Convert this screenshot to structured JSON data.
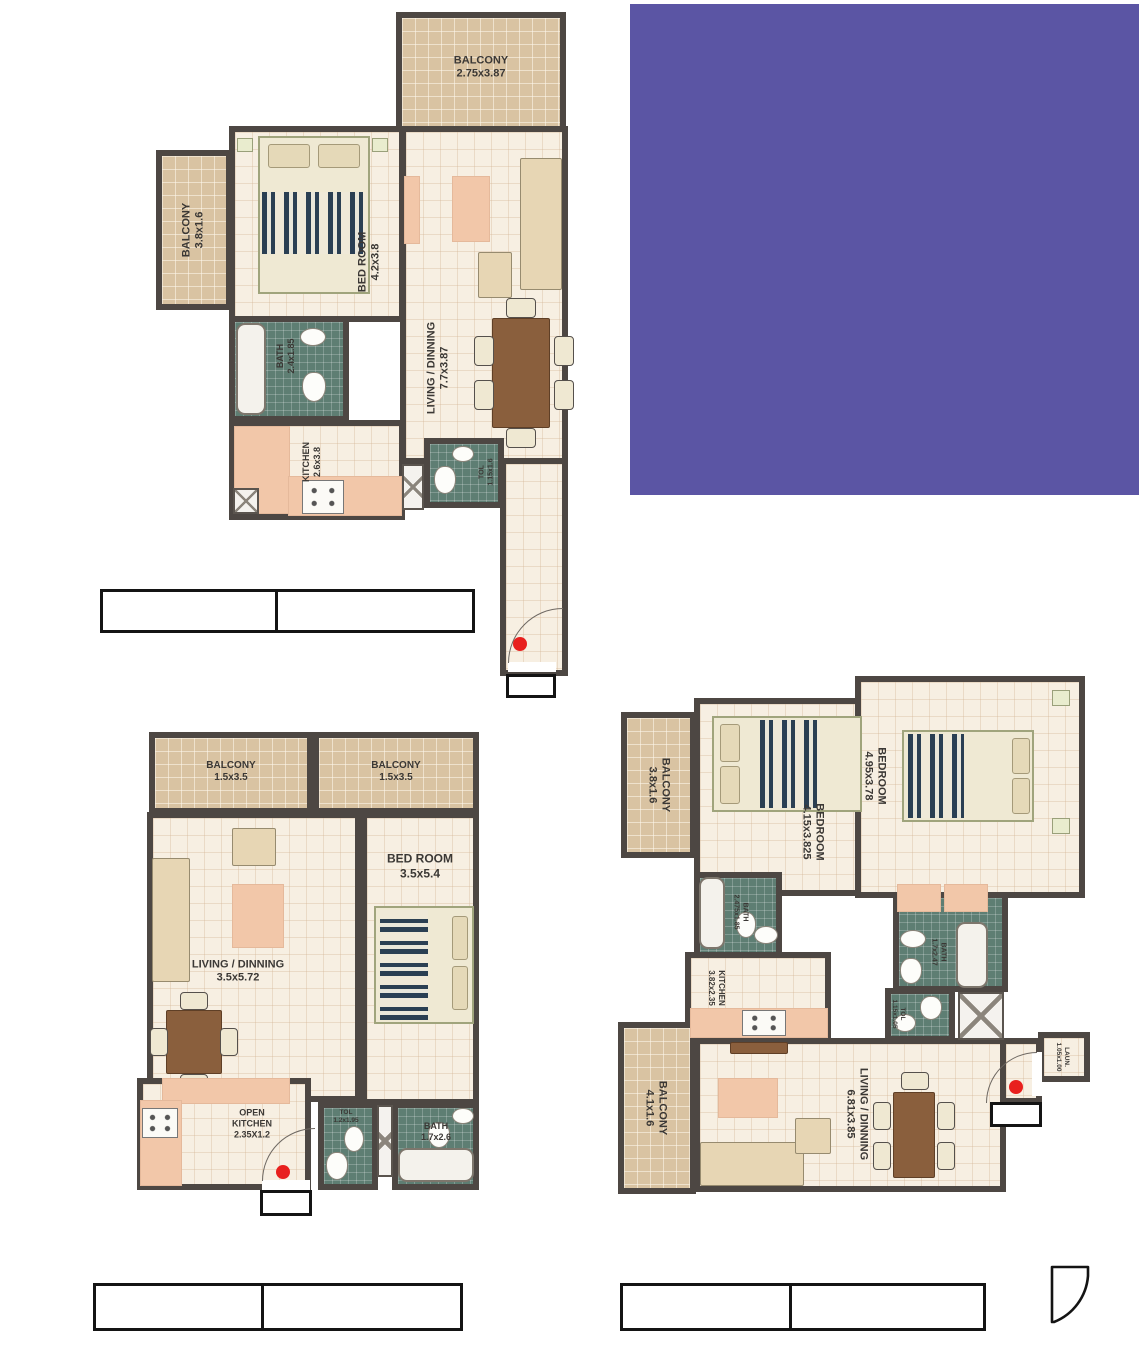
{
  "colors": {
    "purple_block": "#5b55a4",
    "wall": "#4d4743",
    "floor_tile": "#f7efe2",
    "balcony_tile": "#d9c3a2",
    "bath_tile": "#5e7e73",
    "entry_dot": "#e8201e"
  },
  "plan1": {
    "balcony_top": {
      "name": "BALCONY",
      "dims": "2.75x3.87"
    },
    "balcony_left": {
      "name": "BALCONY",
      "dims": "3.8x1.6"
    },
    "bedroom": {
      "name": "BED ROOM",
      "dims": "4.2x3.8"
    },
    "living": {
      "name": "LIVING / DINNING",
      "dims": "7.7x3.87"
    },
    "bath": {
      "name": "BATH",
      "dims": "2.4x1.85"
    },
    "kitchen": {
      "name": "KITCHEN",
      "dims": "2.6x3.8"
    },
    "toilet": {
      "name": "TOL",
      "dims": "1.15x1.6"
    }
  },
  "plan2": {
    "balcony_a": {
      "name": "BALCONY",
      "dims": "1.5x3.5"
    },
    "balcony_b": {
      "name": "BALCONY",
      "dims": "1.5x3.5"
    },
    "bedroom": {
      "name": "BED ROOM",
      "dims": "3.5x5.4"
    },
    "living": {
      "name": "LIVING / DINNING",
      "dims": "3.5x5.72"
    },
    "kitchen": {
      "name": "OPEN KITCHEN",
      "dims": "2.35X1.2"
    },
    "toilet": {
      "name": "TOL",
      "dims": "1.2x1.95"
    },
    "bath": {
      "name": "BATH",
      "dims": "1.7x2.6"
    }
  },
  "plan3": {
    "balcony_top": {
      "name": "BALCONY",
      "dims": "3.8x1.6"
    },
    "bedroom1": {
      "name": "BEDROOM",
      "dims": "4.15x3.825"
    },
    "bedroom2": {
      "name": "BEDROOM",
      "dims": "4.95x3.78"
    },
    "bath1": {
      "name": "BATH",
      "dims": "2.475x1.85"
    },
    "bath2": {
      "name": "BATH",
      "dims": "1.7x2.47"
    },
    "kitchen": {
      "name": "KITCHEN",
      "dims": "3.82x2.35"
    },
    "toilet": {
      "name": "TOL",
      "dims": "1.15x1.05"
    },
    "balcony_bottom": {
      "name": "BALCONY",
      "dims": "4.1x1.6"
    },
    "living": {
      "name": "LIVING / DINNING",
      "dims": "6.81x3.85"
    },
    "laundry": {
      "name": "LAUN.",
      "dims": "1.05x1.00"
    }
  }
}
